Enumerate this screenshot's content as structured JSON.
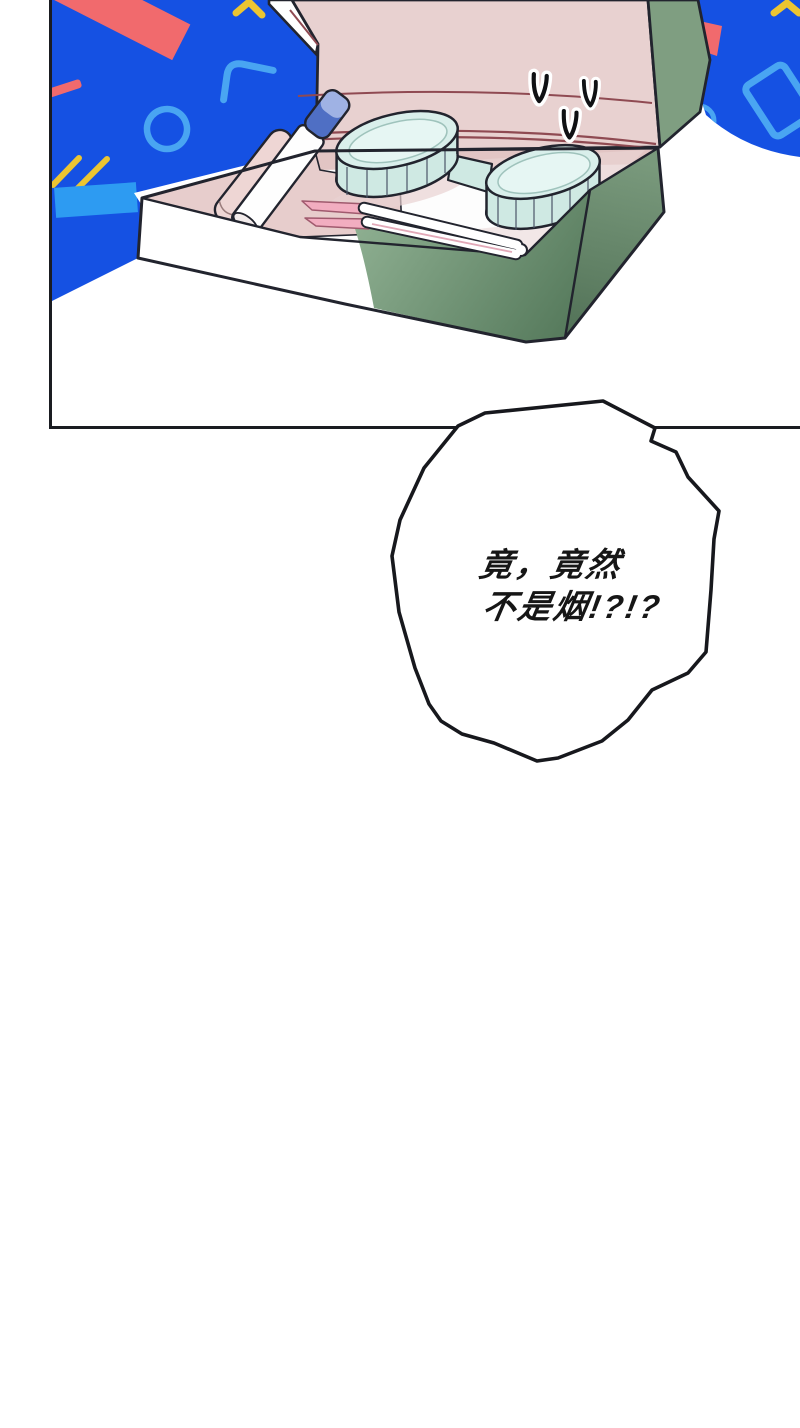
{
  "page": {
    "type": "comic-panel-page",
    "background": "#ffffff"
  },
  "speech_bubble": {
    "lines": [
      "竟，竟然",
      "不是烟!?!?"
    ],
    "text_color": "#161616",
    "fill": "#ffffff",
    "stroke": "#17181d"
  },
  "panel": {
    "border_color": "#1a1c21"
  },
  "scene": {
    "box_contents": [
      "contact-lens-case",
      "solution-tube",
      "tweezers",
      "pink-roll"
    ],
    "decorative_shapes": [
      "red-band",
      "red-strip",
      "yellow-corner-bracket",
      "azure-circle-outline",
      "azure-rounded-bracket",
      "yellow-double-lines",
      "azure-rectangle",
      "red-diamond",
      "yellow-chevron",
      "azure-rect-outline",
      "azure-small-circle",
      "surprise-v-marks"
    ]
  },
  "palette": {
    "blue": "#1551e3",
    "azure": "#2d9bf2",
    "azure2": "#49a5f2",
    "red": "#f16a6d",
    "yellow": "#ecc531",
    "outline": "#22242e",
    "lid-pink": "#e8d1d0",
    "wall-pink": "#e7cdcc",
    "band-pink": "#e2c5c4",
    "roll-pink": "#eed6d4",
    "shadow-pink": "#e8d2d1",
    "crease-red": "#8f4a52",
    "green-flap": "#7f9e81",
    "green-front-a": "#8fb092",
    "green-front-b": "#567a5c",
    "green-side-a": "#79997c",
    "green-side-b": "#527257",
    "mint-top": "#d9efeb",
    "mint-inner": "#e6f6f3",
    "mint-wall": "#cfe9e3",
    "rib": "#4c5668",
    "cap-blue": "#4f6fc4",
    "cap-light": "#9fb2e4",
    "tweezer-pink": "#f2adc0",
    "tweezer-edge": "#a05a6e",
    "floor-white": "#fdfdfd"
  }
}
